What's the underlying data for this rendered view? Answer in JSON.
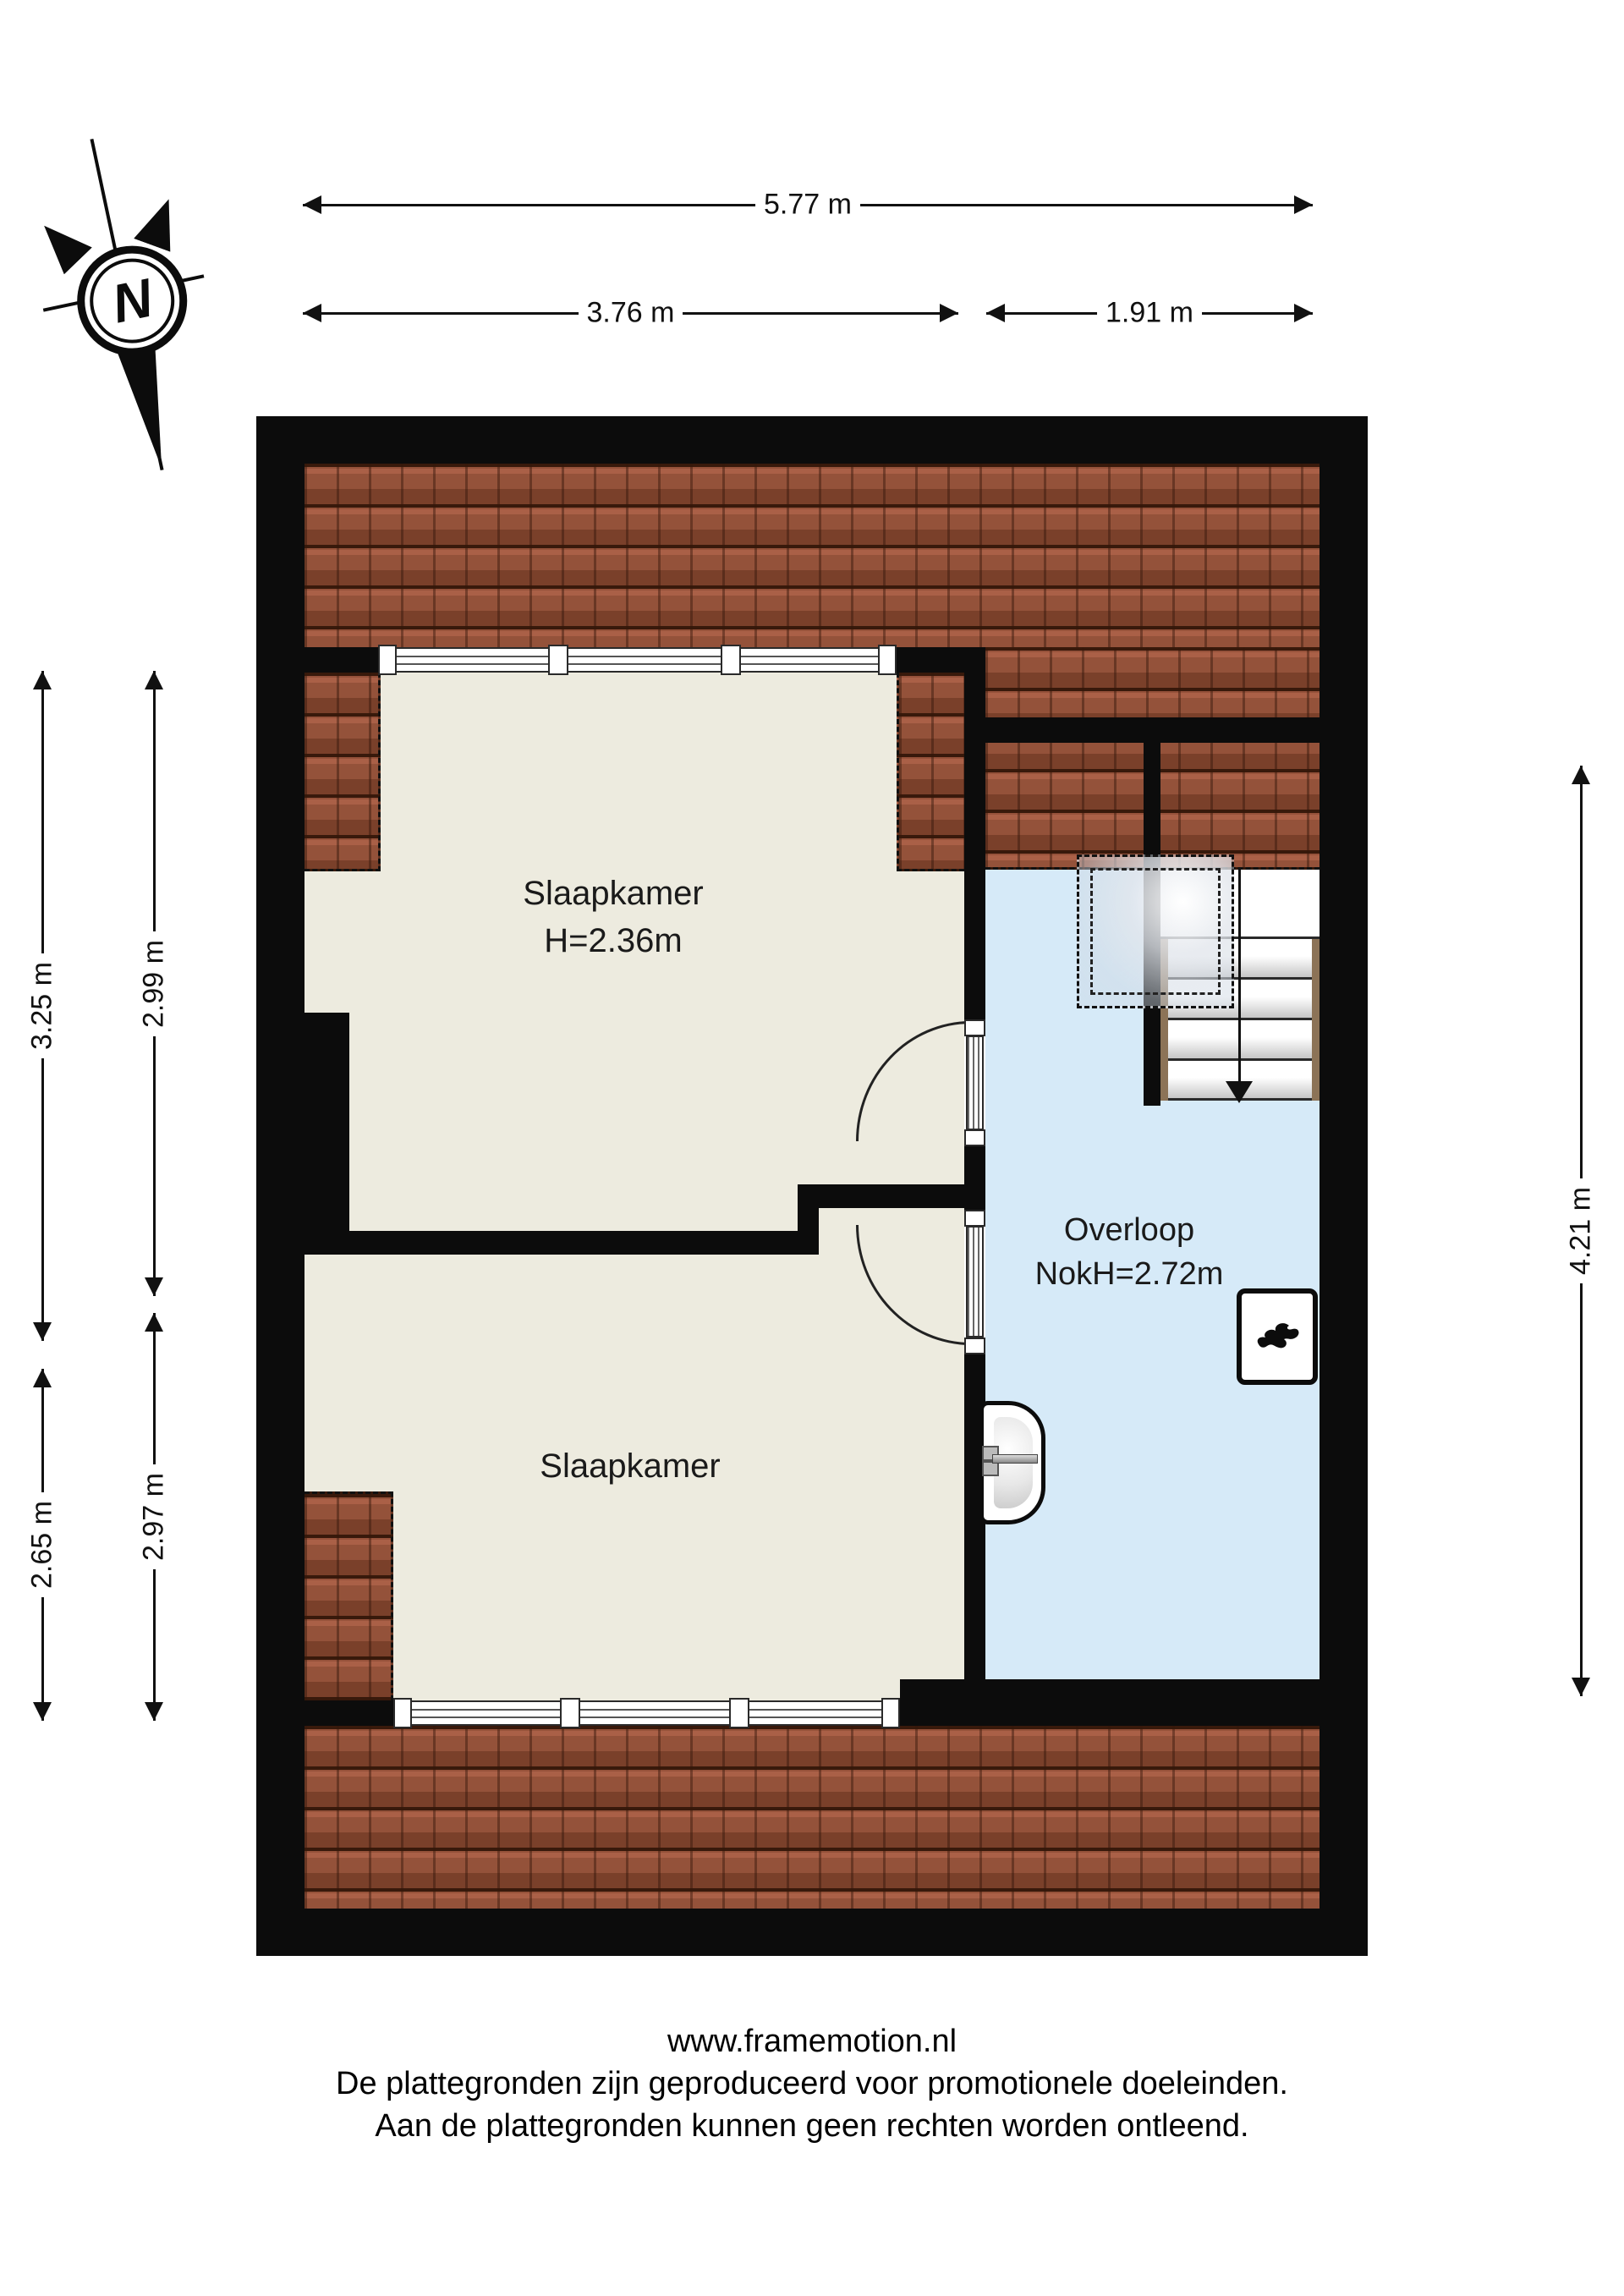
{
  "compass": {
    "label": "N"
  },
  "dimensions": {
    "top_total": "5.77 m",
    "top_left": "3.76 m",
    "top_right": "1.91 m",
    "left_outer_top": "3.25 m",
    "left_inner_top": "2.99 m",
    "left_outer_bottom": "2.65 m",
    "left_inner_bottom": "2.97 m",
    "right_side": "4.21 m"
  },
  "rooms": {
    "bedroom1": {
      "name": "Slaapkamer",
      "height": "H=2.36m"
    },
    "bedroom2": {
      "name": "Slaapkamer"
    },
    "landing": {
      "name": "Overloop",
      "ridge_height": "NokH=2.72m"
    }
  },
  "footer": {
    "line1": "www.framemotion.nl",
    "line2": "De plattegronden zijn geproduceerd voor promotionele doeleinden.",
    "line3": "Aan de plattegronden kunnen geen rechten worden ontleend."
  },
  "colors": {
    "wall": "#0c0c0c",
    "roof_tiles": "#96523a",
    "room_floor": "#edebdf",
    "landing_floor": "#d6eaf8",
    "stair_stringer": "#8c7357"
  }
}
